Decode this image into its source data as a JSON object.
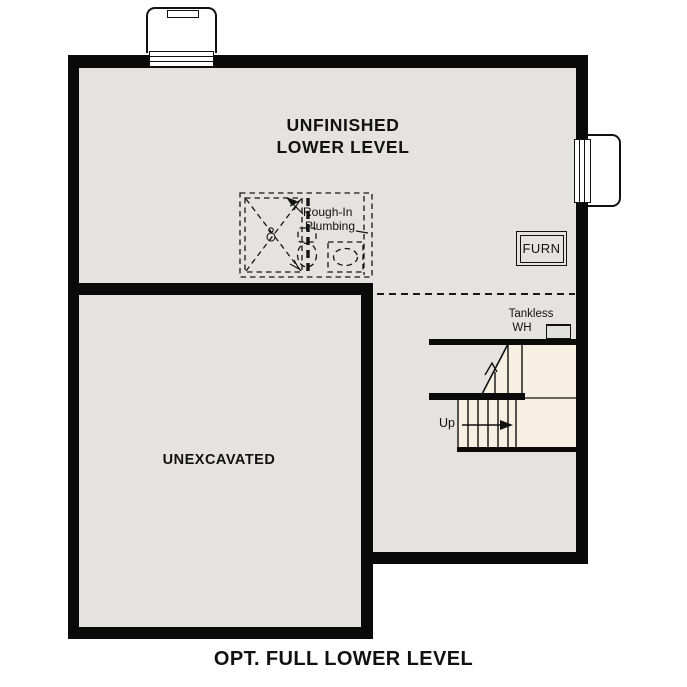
{
  "plan": {
    "room_title_line1": "UNFINISHED",
    "room_title_line2": "LOWER LEVEL",
    "caption": "OPT. FULL LOWER LEVEL",
    "rooms": {
      "unexcavated": "UNEXCAVATED"
    },
    "labels": {
      "furnace": "FURN",
      "tankless_line1": "Tankless",
      "tankless_line2": "WH",
      "plumbing_line1": "Rough-In",
      "plumbing_line2": "Plumbing",
      "stairs_up": "Up"
    },
    "colors": {
      "wall": "#0a0a0a",
      "floor": "#e4e3e0",
      "stairs": "#f7efe2",
      "appliance": "#e0e0dd",
      "text": "#111111",
      "background": "#ffffff"
    }
  }
}
